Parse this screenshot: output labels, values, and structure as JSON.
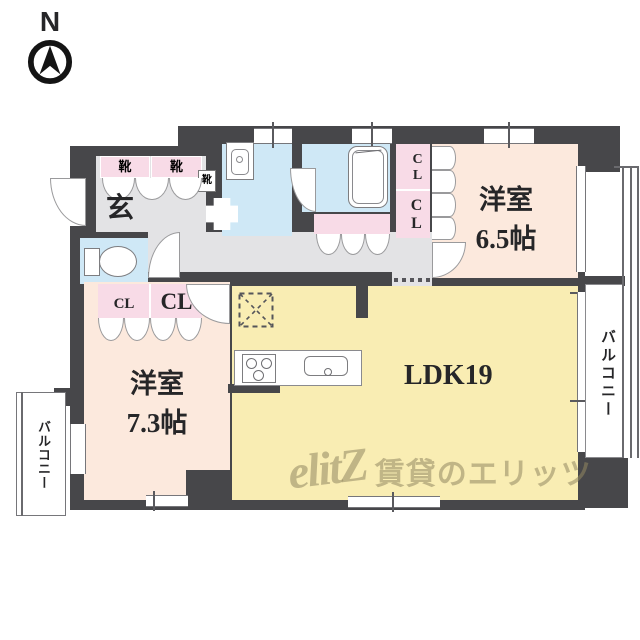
{
  "compass": {
    "label": "N"
  },
  "entrance": {
    "label": "玄"
  },
  "shoes": {
    "box1": "靴",
    "box2": "靴",
    "box3": "靴"
  },
  "closets": {
    "right_top": "CL",
    "right_bottom": "CL",
    "left_small": "CL",
    "left_large": "CL"
  },
  "rooms": {
    "bedroom_right": {
      "name": "洋室",
      "size": "6.5帖"
    },
    "bedroom_left": {
      "name": "洋室",
      "size": "7.3帖"
    },
    "ldk": {
      "label": "LDK19"
    }
  },
  "balconies": {
    "right": "バルコニー",
    "left": "バルコニー"
  },
  "watermark": {
    "logo": "elitZ",
    "text": "賃貸のエリッツ"
  },
  "colors": {
    "wall": "#47474a",
    "bedroom": "#fce9dd",
    "ldk": "#f9edb3",
    "wet_area": "#cfe8f6",
    "closet": "#f8dbe7",
    "hallway": "#e3e3e5"
  }
}
